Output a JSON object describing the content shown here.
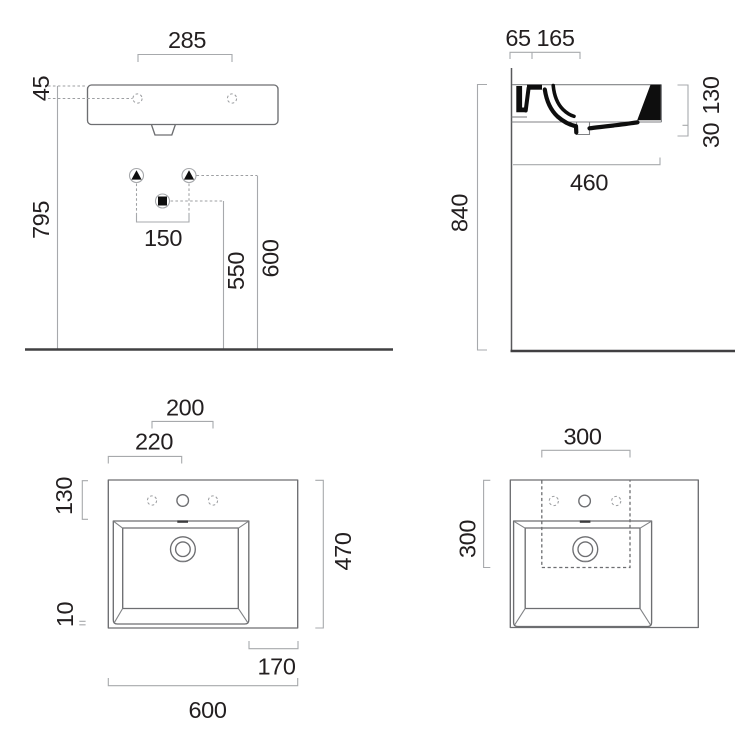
{
  "drawing_title": "wall-hung washbasin technical drawing (4 views)",
  "colors": {
    "background": "#ffffff",
    "outline_gray": "#6d6e71",
    "dimension_gray": "#a7a9ac",
    "text_color": "#231f20",
    "section_black": "#0e0e0e",
    "floor_gray": "#414042"
  },
  "views": {
    "front_elevation": {
      "labels": {
        "tap_hole_spacing": "285",
        "rim_to_tap_hole": "45",
        "tap_hole_to_floor": "795",
        "fixing_hole_spacing": "150",
        "drain_to_floor": "550",
        "fixing_to_floor": "600"
      }
    },
    "side_section": {
      "labels": {
        "wall_to_tap": "65",
        "tap_to_bowl": "165",
        "rim_to_floor": "840",
        "basin_height": "130",
        "apron_drop": "30",
        "basin_depth": "460"
      }
    },
    "plan": {
      "labels": {
        "outer_tap_spacing": "200",
        "edge_to_centre_tap": "220",
        "back_edge_to_bowl": "130",
        "bowl_to_front_edge": "10",
        "total_depth": "470",
        "bowl_to_right_edge": "170",
        "total_width": "600"
      }
    },
    "plan_cutout": {
      "labels": {
        "cutout_width": "300",
        "cutout_depth": "300"
      }
    }
  }
}
